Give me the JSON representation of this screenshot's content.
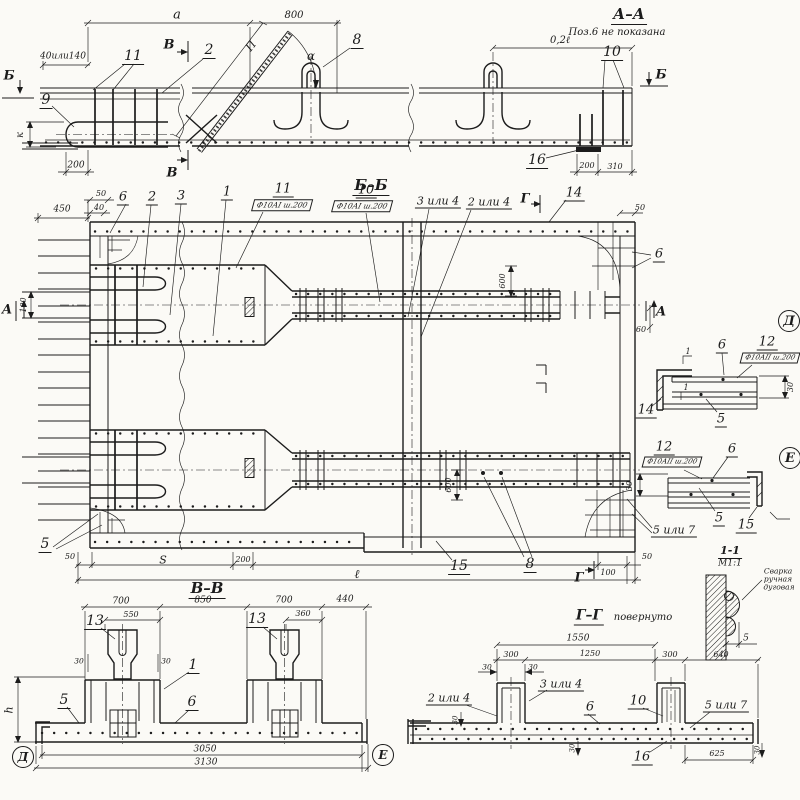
{
  "palette": {
    "paper": "#fbfaf6",
    "ink": "#1c1c1c"
  },
  "drawing_type": "reinforcement-working-drawing",
  "annotations": [
    {
      "name": "section-aa-title",
      "group": "aa",
      "text": "А–А",
      "x": 629,
      "y": 16,
      "fs": 15,
      "cls": "title"
    },
    {
      "name": "section-aa-note",
      "group": "aa",
      "text": "Поз.6 не показана",
      "x": 617,
      "y": 33,
      "fs": 10,
      "cls": "note"
    },
    {
      "name": "dim-a",
      "group": "aa",
      "text": "а",
      "x": 177,
      "y": 15,
      "fs": 13
    },
    {
      "name": "dim-800",
      "group": "aa",
      "text": "800",
      "x": 294,
      "y": 16,
      "fs": 10
    },
    {
      "name": "dim-0-2l",
      "group": "aa",
      "text": "0,2ℓ",
      "x": 560,
      "y": 41,
      "fs": 10
    },
    {
      "name": "dim-40-140",
      "group": "aa",
      "text": "40или140",
      "x": 63,
      "y": 57,
      "fs": 9
    },
    {
      "name": "marker-b-left",
      "group": "aa",
      "text": "Б",
      "x": 9,
      "y": 76,
      "fs": 13,
      "cls": "mark"
    },
    {
      "name": "pos-9",
      "group": "aa",
      "text": "9",
      "x": 46,
      "y": 101,
      "fs": 14,
      "cls": "pos"
    },
    {
      "name": "pos-11-aa",
      "group": "aa",
      "text": "11",
      "x": 133,
      "y": 57,
      "fs": 14,
      "cls": "pos"
    },
    {
      "name": "pos-2-aa",
      "group": "aa",
      "text": "2",
      "x": 209,
      "y": 51,
      "fs": 14,
      "cls": "pos"
    },
    {
      "name": "marker-v-top",
      "group": "aa",
      "text": "В",
      "x": 169,
      "y": 45,
      "fs": 13,
      "cls": "mark"
    },
    {
      "name": "marker-v-bottom",
      "group": "aa",
      "text": "В",
      "x": 172,
      "y": 173,
      "fs": 13,
      "cls": "mark"
    },
    {
      "name": "dim-p",
      "group": "aa",
      "text": "П",
      "x": 251,
      "y": 46,
      "fs": 11,
      "rot": -52
    },
    {
      "name": "dim-alpha",
      "group": "aa",
      "text": "α",
      "x": 311,
      "y": 56,
      "fs": 12
    },
    {
      "name": "pos-8",
      "group": "aa",
      "text": "8",
      "x": 357,
      "y": 41,
      "fs": 14,
      "cls": "pos"
    },
    {
      "name": "marker-b-right",
      "group": "aa",
      "text": "Б",
      "x": 661,
      "y": 75,
      "fs": 13,
      "cls": "mark"
    },
    {
      "name": "pos-10-aa",
      "group": "aa",
      "text": "10",
      "x": 612,
      "y": 53,
      "fs": 14,
      "cls": "pos"
    },
    {
      "name": "pos-16-aa",
      "group": "aa",
      "text": "16",
      "x": 537,
      "y": 161,
      "fs": 14,
      "cls": "pos"
    },
    {
      "name": "dim-200-aa",
      "group": "aa",
      "text": "200",
      "x": 76,
      "y": 166,
      "fs": 9
    },
    {
      "name": "dim-k",
      "group": "aa",
      "text": "к",
      "x": 21,
      "y": 135,
      "fs": 10,
      "rot": -90
    },
    {
      "name": "dim-200-right",
      "group": "aa",
      "text": "200",
      "x": 587,
      "y": 166,
      "fs": 8
    },
    {
      "name": "dim-310",
      "group": "aa",
      "text": "310",
      "x": 615,
      "y": 167,
      "fs": 8
    },
    {
      "name": "section-bb-title",
      "group": "bb",
      "text": "Б–Б",
      "x": 371,
      "y": 187,
      "fs": 15,
      "cls": "title"
    },
    {
      "name": "pos-6-tl",
      "group": "bb",
      "text": "6",
      "x": 123,
      "y": 198,
      "fs": 13,
      "cls": "pos"
    },
    {
      "name": "pos-2-bb",
      "group": "bb",
      "text": "2",
      "x": 152,
      "y": 198,
      "fs": 13,
      "cls": "pos"
    },
    {
      "name": "pos-3-bb",
      "group": "bb",
      "text": "3",
      "x": 181,
      "y": 197,
      "fs": 13,
      "cls": "pos"
    },
    {
      "name": "pos-1-bb",
      "group": "bb",
      "text": "1",
      "x": 227,
      "y": 193,
      "fs": 13,
      "cls": "pos"
    },
    {
      "name": "pos-11-bb",
      "group": "bb",
      "text": "11",
      "x": 283,
      "y": 190,
      "fs": 13,
      "cls": "pos"
    },
    {
      "name": "flag-11",
      "group": "bb",
      "text": "Ф10АI ш.200",
      "x": 282,
      "y": 205,
      "fs": 7.5,
      "cls": "flag",
      "skew": -15
    },
    {
      "name": "pos-10-bb",
      "group": "bb",
      "text": "10",
      "x": 366,
      "y": 191,
      "fs": 13,
      "cls": "pos"
    },
    {
      "name": "flag-10",
      "group": "bb",
      "text": "Ф10АI ш.200",
      "x": 362,
      "y": 206,
      "fs": 7.5,
      "cls": "flag",
      "skew": -15
    },
    {
      "name": "pos-3or4-bb",
      "group": "bb",
      "text": "3 или 4",
      "x": 438,
      "y": 202,
      "fs": 11,
      "cls": "pos"
    },
    {
      "name": "pos-2or4-bb",
      "group": "bb",
      "text": "2 или 4",
      "x": 489,
      "y": 203,
      "fs": 11,
      "cls": "pos"
    },
    {
      "name": "marker-g-top",
      "group": "bb",
      "text": "Г",
      "x": 525,
      "y": 199,
      "fs": 13,
      "cls": "mark"
    },
    {
      "name": "pos-14-bb",
      "group": "bb",
      "text": "14",
      "x": 574,
      "y": 194,
      "fs": 13,
      "cls": "pos"
    },
    {
      "name": "dim-50-tr",
      "group": "bb",
      "text": "50",
      "x": 640,
      "y": 208,
      "fs": 8
    },
    {
      "name": "pos-6-tr",
      "group": "bb",
      "text": "6",
      "x": 659,
      "y": 255,
      "fs": 13,
      "cls": "pos"
    },
    {
      "name": "dim-450",
      "group": "bb",
      "text": "450",
      "x": 62,
      "y": 210,
      "fs": 9
    },
    {
      "name": "dim-50-tl",
      "group": "bb",
      "text": "50",
      "x": 101,
      "y": 194,
      "fs": 8
    },
    {
      "name": "dim-40-tl",
      "group": "bb",
      "text": "40",
      "x": 99,
      "y": 208,
      "fs": 8
    },
    {
      "name": "marker-a-left",
      "group": "bb",
      "text": "А",
      "x": 7,
      "y": 310,
      "fs": 13,
      "cls": "mark"
    },
    {
      "name": "dim-100-left",
      "group": "bb",
      "text": "100",
      "x": 24,
      "y": 305,
      "fs": 8,
      "rot": -90
    },
    {
      "name": "marker-a-right",
      "group": "bb",
      "text": "А",
      "x": 661,
      "y": 312,
      "fs": 13,
      "cls": "mark"
    },
    {
      "name": "dim-60",
      "group": "bb",
      "text": "60",
      "x": 641,
      "y": 330,
      "fs": 8
    },
    {
      "name": "dim-600-top",
      "group": "bb",
      "text": "600",
      "x": 503,
      "y": 281,
      "fs": 8,
      "rot": -90
    },
    {
      "name": "dim-600-bot",
      "group": "bb",
      "text": "600",
      "x": 449,
      "y": 485,
      "fs": 8,
      "rot": -90
    },
    {
      "name": "pos-5-bl",
      "group": "bb",
      "text": "5",
      "x": 45,
      "y": 545,
      "fs": 14,
      "cls": "pos"
    },
    {
      "name": "dim-50-bl",
      "group": "bb",
      "text": "50",
      "x": 70,
      "y": 557,
      "fs": 8
    },
    {
      "name": "dim-s",
      "group": "bb",
      "text": "S",
      "x": 163,
      "y": 560,
      "fs": 11
    },
    {
      "name": "dim-200-bot",
      "group": "bb",
      "text": "200",
      "x": 243,
      "y": 560,
      "fs": 8
    },
    {
      "name": "dim-l",
      "group": "bb",
      "text": "ℓ",
      "x": 357,
      "y": 574,
      "fs": 12
    },
    {
      "name": "pos-15-bb",
      "group": "bb",
      "text": "15",
      "x": 459,
      "y": 567,
      "fs": 14,
      "cls": "pos"
    },
    {
      "name": "pos-8-bb",
      "group": "bb",
      "text": "8",
      "x": 530,
      "y": 565,
      "fs": 14,
      "cls": "pos"
    },
    {
      "name": "marker-g-bot",
      "group": "bb",
      "text": "Г",
      "x": 579,
      "y": 578,
      "fs": 13,
      "cls": "mark"
    },
    {
      "name": "dim-100-bot",
      "group": "bb",
      "text": "100",
      "x": 608,
      "y": 573,
      "fs": 8
    },
    {
      "name": "dim-50-br",
      "group": "bb",
      "text": "50",
      "x": 647,
      "y": 557,
      "fs": 8
    },
    {
      "name": "pos-5or7-plan",
      "group": "bb",
      "text": "5 или 7",
      "x": 674,
      "y": 531,
      "fs": 11,
      "cls": "pos"
    },
    {
      "name": "detail-d-mark",
      "group": "detail-d",
      "text": "Д",
      "x": 789,
      "y": 321,
      "fs": 13,
      "cls": "circ"
    },
    {
      "name": "pos-6-d",
      "group": "detail-d",
      "text": "6",
      "x": 722,
      "y": 346,
      "fs": 13,
      "cls": "pos"
    },
    {
      "name": "pos-12-d",
      "group": "detail-d",
      "text": "12",
      "x": 767,
      "y": 343,
      "fs": 13,
      "cls": "pos"
    },
    {
      "name": "flag-12-d",
      "group": "detail-d",
      "text": "Ф10АII ш.200",
      "x": 770,
      "y": 358,
      "fs": 7,
      "cls": "flag",
      "skew": -15
    },
    {
      "name": "weld-mark-1a",
      "group": "detail-d",
      "text": "1",
      "x": 688,
      "y": 352,
      "fs": 8
    },
    {
      "name": "weld-mark-1b",
      "group": "detail-d",
      "text": "1",
      "x": 686,
      "y": 388,
      "fs": 8
    },
    {
      "name": "pos-14-d",
      "group": "detail-d",
      "text": "14",
      "x": 646,
      "y": 411,
      "fs": 13,
      "cls": "pos"
    },
    {
      "name": "pos-5-d",
      "group": "detail-d",
      "text": "5",
      "x": 721,
      "y": 420,
      "fs": 13,
      "cls": "pos"
    },
    {
      "name": "dim-30-d",
      "group": "detail-d",
      "text": "30",
      "x": 791,
      "y": 387,
      "fs": 8,
      "rot": -90
    },
    {
      "name": "detail-e-mark",
      "group": "detail-e",
      "text": "Е",
      "x": 790,
      "y": 458,
      "fs": 13,
      "cls": "circ"
    },
    {
      "name": "pos-12-e",
      "group": "detail-e",
      "text": "12",
      "x": 664,
      "y": 448,
      "fs": 13,
      "cls": "pos"
    },
    {
      "name": "flag-12-e",
      "group": "detail-e",
      "text": "Ф10АII ш.200",
      "x": 672,
      "y": 462,
      "fs": 7,
      "cls": "flag",
      "skew": -15
    },
    {
      "name": "pos-6-e",
      "group": "detail-e",
      "text": "6",
      "x": 732,
      "y": 450,
      "fs": 13,
      "cls": "pos"
    },
    {
      "name": "dim-30-e",
      "group": "detail-e",
      "text": "30",
      "x": 630,
      "y": 486,
      "fs": 8,
      "rot": -90
    },
    {
      "name": "pos-5-e",
      "group": "detail-e",
      "text": "5",
      "x": 719,
      "y": 519,
      "fs": 13,
      "cls": "pos"
    },
    {
      "name": "pos-15-e",
      "group": "detail-e",
      "text": "15",
      "x": 746,
      "y": 526,
      "fs": 13,
      "cls": "pos"
    },
    {
      "name": "weld-title",
      "group": "weld",
      "text": "1-1",
      "x": 730,
      "y": 552,
      "fs": 11,
      "cls": "title"
    },
    {
      "name": "weld-scale",
      "group": "weld",
      "text": "М1:1",
      "x": 730,
      "y": 564,
      "fs": 9
    },
    {
      "name": "weld-note-1",
      "group": "weld",
      "text": "Сварка",
      "x": 778,
      "y": 571,
      "fs": 7.5
    },
    {
      "name": "weld-note-2",
      "group": "weld",
      "text": "ручная",
      "x": 778,
      "y": 579,
      "fs": 7.5
    },
    {
      "name": "weld-note-3",
      "group": "weld",
      "text": "дуговая",
      "x": 779,
      "y": 587,
      "fs": 7.5
    },
    {
      "name": "dim-5-weld",
      "group": "weld",
      "text": "5",
      "x": 746,
      "y": 639,
      "fs": 9
    },
    {
      "name": "section-vv-title",
      "group": "vv",
      "text": "В–В",
      "x": 207,
      "y": 590,
      "fs": 15,
      "cls": "title"
    },
    {
      "name": "dim-700-l",
      "group": "vv",
      "text": "700",
      "x": 121,
      "y": 602,
      "fs": 9
    },
    {
      "name": "dim-850",
      "group": "vv",
      "text": "850",
      "x": 203,
      "y": 601,
      "fs": 9
    },
    {
      "name": "dim-700-r",
      "group": "vv",
      "text": "700",
      "x": 284,
      "y": 601,
      "fs": 9
    },
    {
      "name": "dim-440",
      "group": "vv",
      "text": "440",
      "x": 345,
      "y": 600,
      "fs": 9
    },
    {
      "name": "dim-550",
      "group": "vv",
      "text": "550",
      "x": 131,
      "y": 615,
      "fs": 8
    },
    {
      "name": "dim-360",
      "group": "vv",
      "text": "360",
      "x": 303,
      "y": 614,
      "fs": 8
    },
    {
      "name": "pos-13-l",
      "group": "vv",
      "text": "13",
      "x": 95,
      "y": 622,
      "fs": 14,
      "cls": "pos"
    },
    {
      "name": "pos-13-r",
      "group": "vv",
      "text": "13",
      "x": 257,
      "y": 620,
      "fs": 14,
      "cls": "pos"
    },
    {
      "name": "dim-30-v1",
      "group": "vv",
      "text": "30",
      "x": 79,
      "y": 661,
      "fs": 7.5
    },
    {
      "name": "dim-30-v2",
      "group": "vv",
      "text": "30",
      "x": 166,
      "y": 661,
      "fs": 7.5
    },
    {
      "name": "pos-1-vv",
      "group": "vv",
      "text": "1",
      "x": 193,
      "y": 666,
      "fs": 14,
      "cls": "pos"
    },
    {
      "name": "pos-5-vv",
      "group": "vv",
      "text": "5",
      "x": 64,
      "y": 701,
      "fs": 14,
      "cls": "pos"
    },
    {
      "name": "pos-6-vv",
      "group": "vv",
      "text": "6",
      "x": 192,
      "y": 703,
      "fs": 14,
      "cls": "pos"
    },
    {
      "name": "dim-h",
      "group": "vv",
      "text": "h",
      "x": 9,
      "y": 710,
      "fs": 11,
      "rot": -90
    },
    {
      "name": "dim-3050",
      "group": "vv",
      "text": "3050",
      "x": 205,
      "y": 750,
      "fs": 9
    },
    {
      "name": "dim-3130",
      "group": "vv",
      "text": "3130",
      "x": 206,
      "y": 763,
      "fs": 9
    },
    {
      "name": "detail-d-ref",
      "group": "vv",
      "text": "Д",
      "x": 23,
      "y": 757,
      "fs": 12,
      "cls": "circ"
    },
    {
      "name": "detail-e-ref",
      "group": "vv",
      "text": "Е",
      "x": 383,
      "y": 755,
      "fs": 12,
      "cls": "circ"
    },
    {
      "name": "section-gg-title",
      "group": "gg",
      "text": "Г–Г",
      "x": 589,
      "y": 617,
      "fs": 14,
      "cls": "title"
    },
    {
      "name": "section-gg-note",
      "group": "gg",
      "text": "повернуто",
      "x": 643,
      "y": 618,
      "fs": 10,
      "cls": "note"
    },
    {
      "name": "dim-1550",
      "group": "gg",
      "text": "1550",
      "x": 578,
      "y": 639,
      "fs": 9
    },
    {
      "name": "dim-300-l",
      "group": "gg",
      "text": "300",
      "x": 511,
      "y": 655,
      "fs": 8
    },
    {
      "name": "dim-1250",
      "group": "gg",
      "text": "1250",
      "x": 590,
      "y": 654,
      "fs": 8
    },
    {
      "name": "dim-300-r",
      "group": "gg",
      "text": "300",
      "x": 670,
      "y": 655,
      "fs": 8
    },
    {
      "name": "dim-640",
      "group": "gg",
      "text": "640",
      "x": 721,
      "y": 655,
      "fs": 8
    },
    {
      "name": "dim-30-g1",
      "group": "gg",
      "text": "30",
      "x": 487,
      "y": 667,
      "fs": 7.5
    },
    {
      "name": "dim-30-g2",
      "group": "gg",
      "text": "30",
      "x": 533,
      "y": 667,
      "fs": 7.5
    },
    {
      "name": "pos-2or4-gg",
      "group": "gg",
      "text": "2 или 4",
      "x": 449,
      "y": 699,
      "fs": 11,
      "cls": "pos"
    },
    {
      "name": "pos-3or4-gg",
      "group": "gg",
      "text": "3 или 4",
      "x": 561,
      "y": 685,
      "fs": 11,
      "cls": "pos"
    },
    {
      "name": "pos-6-gg",
      "group": "gg",
      "text": "6",
      "x": 590,
      "y": 708,
      "fs": 13,
      "cls": "pos"
    },
    {
      "name": "pos-10-gg",
      "group": "gg",
      "text": "10",
      "x": 638,
      "y": 702,
      "fs": 13,
      "cls": "pos"
    },
    {
      "name": "pos-5or7-gg",
      "group": "gg",
      "text": "5 или 7",
      "x": 726,
      "y": 706,
      "fs": 11,
      "cls": "pos"
    },
    {
      "name": "pos-16-gg",
      "group": "gg",
      "text": "16",
      "x": 642,
      "y": 758,
      "fs": 13,
      "cls": "pos"
    },
    {
      "name": "dim-625",
      "group": "gg",
      "text": "625",
      "x": 717,
      "y": 754,
      "fs": 8
    },
    {
      "name": "dim-30-g3",
      "group": "gg",
      "text": "30",
      "x": 456,
      "y": 720,
      "fs": 7,
      "rot": -90
    },
    {
      "name": "dim-30-g4",
      "group": "gg",
      "text": "30",
      "x": 573,
      "y": 748,
      "fs": 7,
      "rot": -90
    },
    {
      "name": "dim-30-g5",
      "group": "gg",
      "text": "30",
      "x": 758,
      "y": 750,
      "fs": 7,
      "rot": -90
    }
  ]
}
